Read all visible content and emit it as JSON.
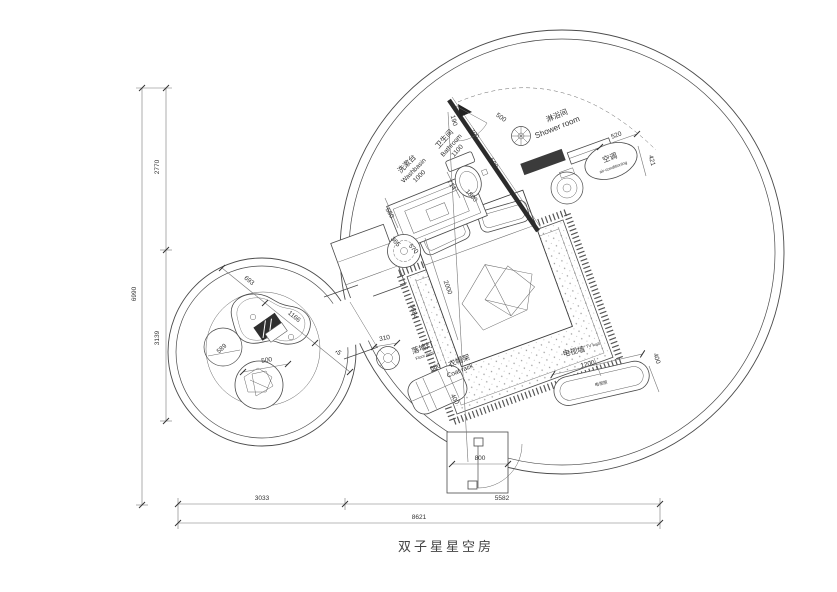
{
  "title": "双子星星空房",
  "labels": {
    "washbasin_zh": "洗漱台",
    "washbasin_en": "Washbasin",
    "washbasin_dim": "1000",
    "bathroom_zh": "卫生间",
    "bathroom_en": "Bathroom",
    "bathroom_dim": "1100",
    "shower_zh": "淋浴间",
    "shower_en": "Shower room",
    "ac_zh": "空调",
    "ac_en": "air-conditioning",
    "lamp_zh": "落地灯",
    "lamp_en": "Floor lamp",
    "coat_zh": "衣帽架",
    "coat_en": "Coat rack",
    "tv_zh": "电视墙",
    "tv_en": "TV wall",
    "tvcab_zh": "电视柜"
  },
  "dims": {
    "d190": "190",
    "d700": "700",
    "d500top": "500",
    "d590": "590",
    "d520": "520",
    "d421": "421",
    "d550": "550",
    "d714": "714",
    "d1800": "1800",
    "d365": "365",
    "d570": "570",
    "d2000": "2000",
    "d5684": "5684",
    "d310": "310",
    "d660": "660",
    "d400c": "400",
    "d1200": "1200",
    "d400t": "400",
    "d800": "800",
    "d693": "693",
    "d1166": "1166",
    "d745": "745",
    "d589": "589",
    "d500s": "500",
    "d2770": "2770",
    "d3139": "3139",
    "d6990": "6990",
    "d3033": "3033",
    "d5582": "5582",
    "d8621": "8621"
  }
}
